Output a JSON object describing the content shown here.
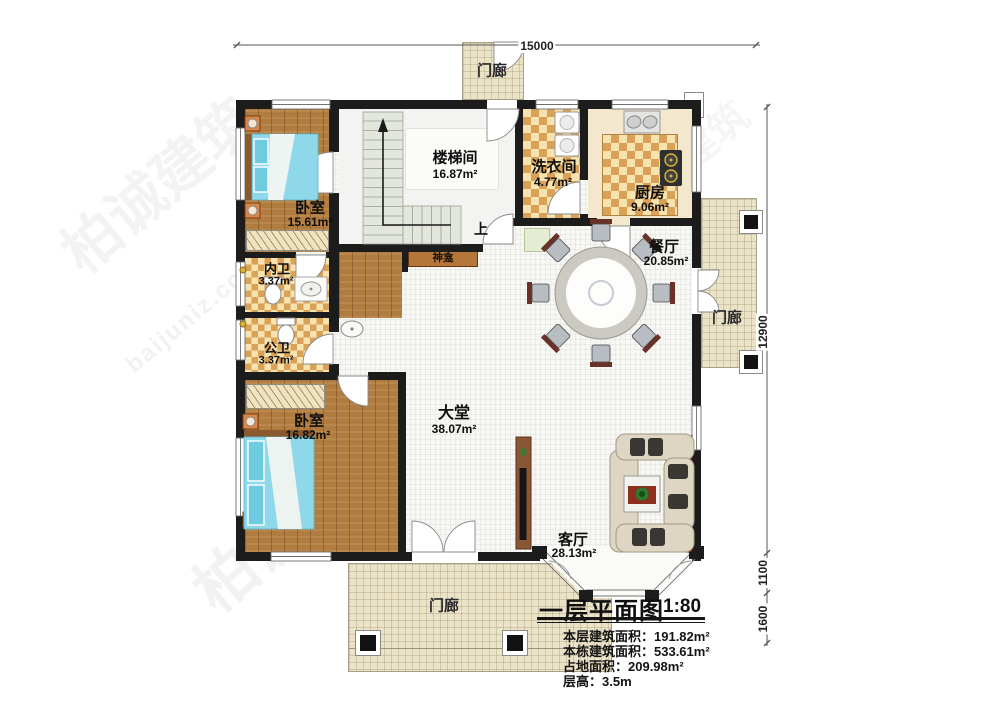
{
  "watermark": {
    "brand": "柏诚建筑",
    "site": "baijuniz.com"
  },
  "dimensions": {
    "top": "15000",
    "right_main": "12900",
    "right_bay": "1100",
    "right_porch": "1600"
  },
  "rooms": {
    "bedroom1": {
      "name": "卧室",
      "area": "15.61m²"
    },
    "stair": {
      "name": "楼梯间",
      "area": "16.87m²"
    },
    "laundry": {
      "name": "洗衣间",
      "area": "4.77m²"
    },
    "kitchen": {
      "name": "厨房",
      "area": "9.06m²"
    },
    "dining": {
      "name": "餐厅",
      "area": "20.85m²"
    },
    "bath_private": {
      "name": "内卫",
      "area": "3.37m²"
    },
    "bath_public": {
      "name": "公卫",
      "area": "3.37m²"
    },
    "bedroom2": {
      "name": "卧室",
      "area": "16.82m²"
    },
    "hall": {
      "name": "大堂",
      "area": "38.07m²"
    },
    "living": {
      "name": "客厅",
      "area": "28.13m²"
    }
  },
  "porch": {
    "top": "门廊",
    "right": "门廊",
    "bottom": "门廊"
  },
  "annot": {
    "up": "上",
    "shrine": "神龛"
  },
  "title_block": {
    "title": "一层平面图",
    "scale": "1:80",
    "notes": [
      "本层建筑面积：191.82m²",
      "本栋建筑面积：533.61m²",
      "占地面积：209.98m²",
      "层高：3.5m"
    ]
  }
}
